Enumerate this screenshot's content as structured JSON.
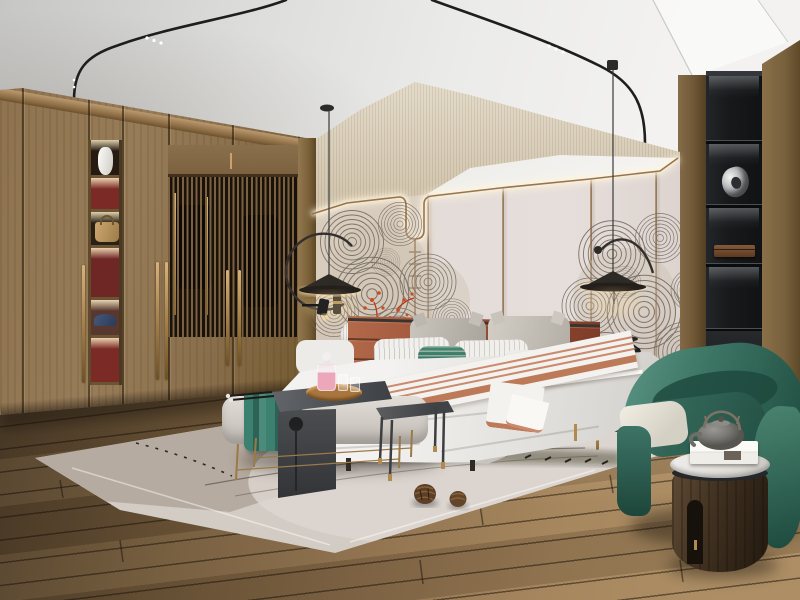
{
  "meta": {
    "domain": "Natural-Image",
    "description": "Photoreal 3D render of a modern Japandi / new-Chinese style bedroom",
    "width_px": 800,
    "height_px": 600
  },
  "palette": {
    "ceiling": "#ededeb",
    "band": "#d8cdbc",
    "panel": "#e2dad6",
    "trim-brass": "#96744f",
    "wood-ward": "#8f7350",
    "wood-right": "#7a6240",
    "floor-mid": "#8a6d4b",
    "floor-dark": "#4e3d29",
    "rug": "#d3ccc5",
    "rug-dark": "#b3a79b",
    "headboard": "#9a4f36",
    "bedding": "#f2f1ef",
    "green": "#3c7464",
    "teal-accent": "#3f8472",
    "charcoal": "#46484b",
    "shelf-black": "#17191b",
    "brass": "#b08a50",
    "coral": "#c2401e",
    "pink": "#eda7ba"
  },
  "scene": {
    "ceiling": {
      "label": "white plaster ceiling",
      "track_light_rails": 2,
      "spotlights": "tiny white dots on curved black magnetic tracks"
    },
    "wardrobe": {
      "label": "full-height walnut wardrobe",
      "features": [
        "slatted glass doors with clothes behind",
        "long brass pull handles",
        "lit display niche column"
      ],
      "niche_items": [
        "white ceramic vase",
        "tan leather handbag",
        "navy baseball cap"
      ],
      "niche_back_color": "#7b2a26"
    },
    "feature_wall": {
      "upper_band": "beige grasscloth with LED cove glow",
      "panels": "blush-grey panels with thin brass trim that dips in a U over a hanging rod",
      "artwork": "grey swirling fan/shell line-art mural with red coral blossoms",
      "rod": "brass rod with small rungs"
    },
    "pendant_lamps": {
      "count": 2,
      "style": "black flat-cone shade, curved arc arm with ball counterweight, warm under-glow"
    },
    "wall_reading_lamp": {
      "label": "small black cylinder lamp on pilaster"
    },
    "bed": {
      "headboard": "terracotta leather with horizontal channel stitching",
      "pillows": [
        "two grey peaked pillows",
        "two white pin-striped pillows",
        "teal striped lumbar pillow",
        "small grey pillow",
        "white bolster"
      ],
      "bedding": "white duvet",
      "runner": "white throw with thin terracotta stripes draped diagonally"
    },
    "nightstand_left": {
      "color": "charcoal",
      "items": [
        "white ribbed gourd vase",
        "dark box"
      ]
    },
    "nightstand_right": {
      "color": "grey drum chest with brass trim and legs",
      "items": [
        "black wire sculpture"
      ]
    },
    "bench": {
      "label": "grey upholstered bench with brass legs",
      "items": [
        "teal folded towel",
        "charcoal waterfall tray-table with round cutout",
        "round wood tray",
        "pink glass decanter",
        "two glasses",
        "incense sticks"
      ]
    },
    "side_table": {
      "label": "thin-leg metal side table, charcoal top, brass feet"
    },
    "rug": {
      "colors": [
        "taupe",
        "blush grey"
      ],
      "pattern": "large pale circle with thin dark curved dashes",
      "props": [
        "two pine cones"
      ]
    },
    "armchair": {
      "label": "forest-green barrel armchair",
      "cushion": "ivory"
    },
    "drum_table": {
      "label": "dark wood drum side table with notch",
      "top": "white marble",
      "items": [
        "white gift box",
        "grey cast-iron teapot with bail handle"
      ]
    },
    "shelf_column": {
      "label": "matte black recessed shelf column",
      "lighting": "LED strip under each shelf",
      "items": [
        "silver abstract sculpture",
        "dark wood box",
        "leaning white books"
      ]
    },
    "right_wall": {
      "label": "walnut plank wall"
    },
    "floor": {
      "label": "wide oak planks in diagonal perspective"
    }
  }
}
